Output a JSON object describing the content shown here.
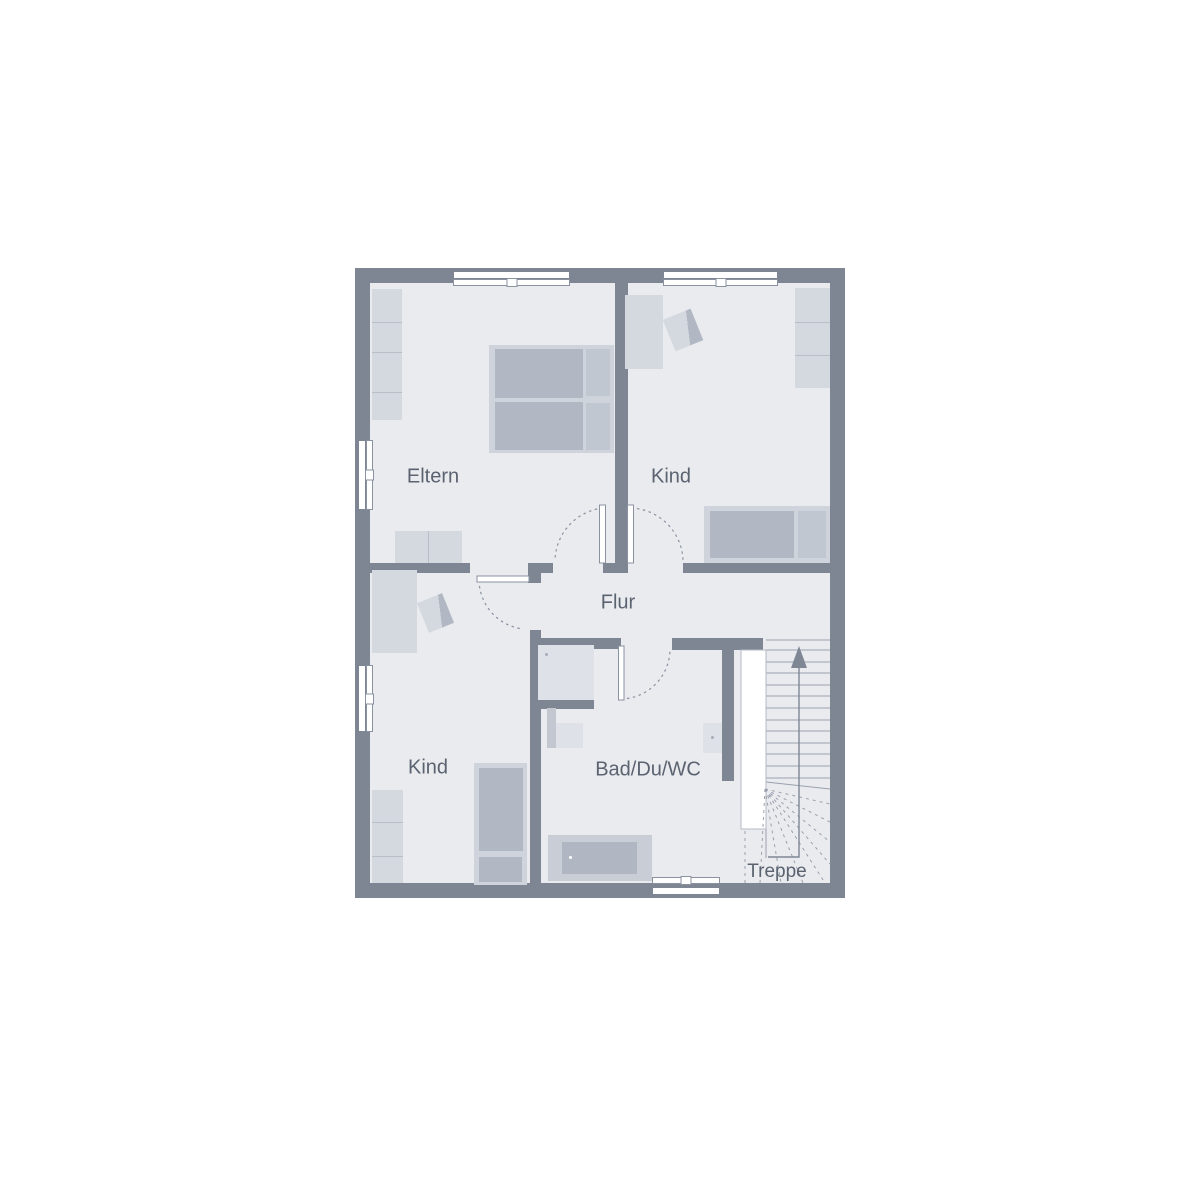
{
  "plan": {
    "title_hidden": "",
    "rooms": {
      "eltern": {
        "label": "Eltern"
      },
      "kind_top": {
        "label": "Kind"
      },
      "kind_bottom": {
        "label": "Kind"
      },
      "flur": {
        "label": "Flur"
      },
      "bad": {
        "label": "Bad/Du/WC"
      },
      "treppe": {
        "label": "Treppe"
      }
    },
    "colors": {
      "wall": "#7e8694",
      "room": "#e9ebef",
      "furniture_light": "#d4d8df",
      "furniture_divider": "#b9bfc8",
      "furniture_medium": "#b2b8c3",
      "bed_frame": "#cfd4dc",
      "pillow": "#c1c7d1",
      "fixture": "#dee1e7",
      "tub_outer": "#c9cdd6",
      "tub_inner": "#b1b7c2",
      "text": "#5b6370",
      "line": "#8a92a0",
      "line_light": "#9aa1ad",
      "arrow": "#7f8795",
      "vanity_side": "#c2c7d0",
      "fixture_dot": "#a6adb8"
    }
  }
}
